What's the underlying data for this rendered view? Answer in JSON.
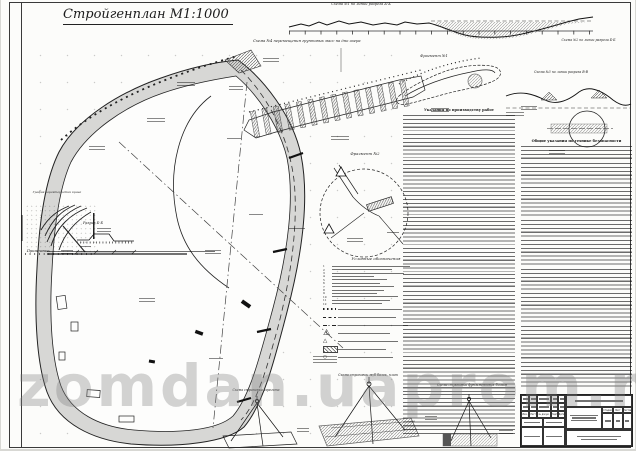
{
  "page": {
    "title": "Стройгенплан М1:1000",
    "watermark": "zomdan.uaprom.ne"
  },
  "labels": {
    "scheme1": "Схема №1 по линии разреза А-А",
    "scheme2": "Схема №2 по линии разреза Б-Б",
    "scheme3": "Схема №3 по линии разреза В-В",
    "scheme4": "Схема №4 перемещения грунтовых масс на дно озера",
    "fragment1": "Фрагмент №1",
    "fragment2": "Фрагмент №2",
    "razrez_bb": "Разрез Б-Б",
    "grafik": "График характеристик крана",
    "note": "Примечание:"
  },
  "legend": {
    "title": "Условные обозначения",
    "numbers": [
      "1",
      "2",
      "3",
      "4",
      "5",
      "6",
      "7",
      "8",
      "9",
      "10",
      "11",
      "12"
    ]
  },
  "columns": {
    "instructions_title": "Указания по производству работ",
    "safety_title": "Общие указания по технике безопасности"
  },
  "slings": {
    "left": "Схема строповки агрегата",
    "middle": "Схема строповки ж/б балок, плит",
    "right": "Схема строповки фундаментных блоков"
  },
  "titleblock": {
    "izm": "Изм.",
    "list": "Лист",
    "ndok": "№ докум.",
    "podp": "Подп.",
    "data": "Дата",
    "stadia": "Стадия",
    "list2": "Лист",
    "listov": "Листов"
  }
}
